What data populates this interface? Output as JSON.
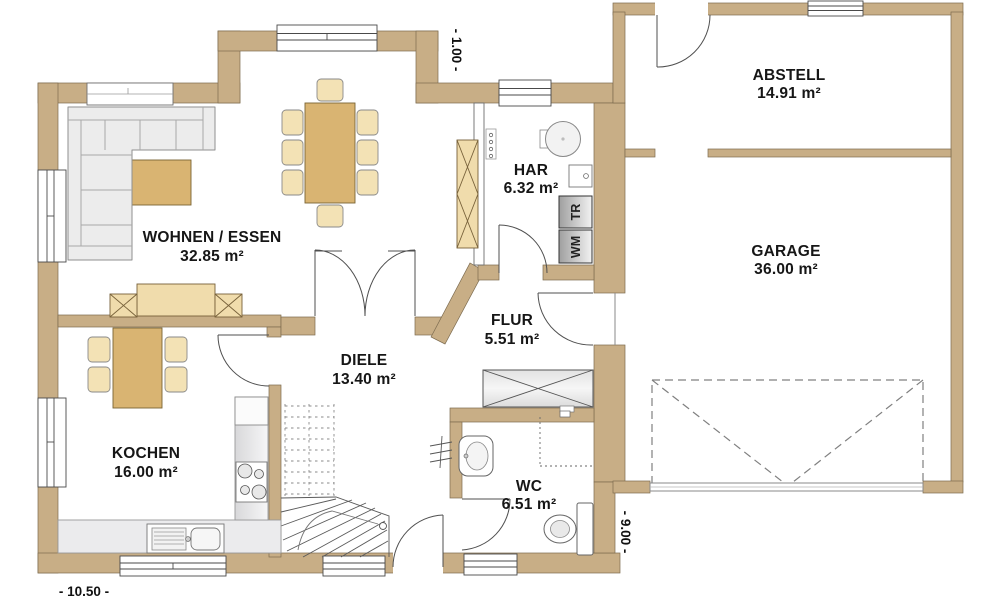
{
  "rooms": [
    {
      "name": "WOHNEN / ESSEN",
      "area": "32.85 m²"
    },
    {
      "name": "KOCHEN",
      "area": "16.00 m²"
    },
    {
      "name": "DIELE",
      "area": "13.40 m²"
    },
    {
      "name": "FLUR",
      "area": "5.51 m²"
    },
    {
      "name": "HAR",
      "area": "6.32 m²"
    },
    {
      "name": "WC",
      "area": "6.51 m²"
    },
    {
      "name": "ABSTELL",
      "area": "14.91 m²"
    },
    {
      "name": "GARAGE",
      "area": "36.00 m²"
    }
  ],
  "appliances": {
    "dryer": "TR",
    "washing_machine": "WM"
  },
  "dimensions": {
    "bottom_width": "- 10.50 -",
    "right_depth": "- 9.00 -",
    "top_offset": "- 1.00 -"
  },
  "colors": {
    "wall": "#C8AE86",
    "wood": "#D9B472",
    "wood_light": "#F0DCAC",
    "chair": "#F3E2B5",
    "counter": "#EBEBED",
    "sofa": "#ECECEC"
  }
}
